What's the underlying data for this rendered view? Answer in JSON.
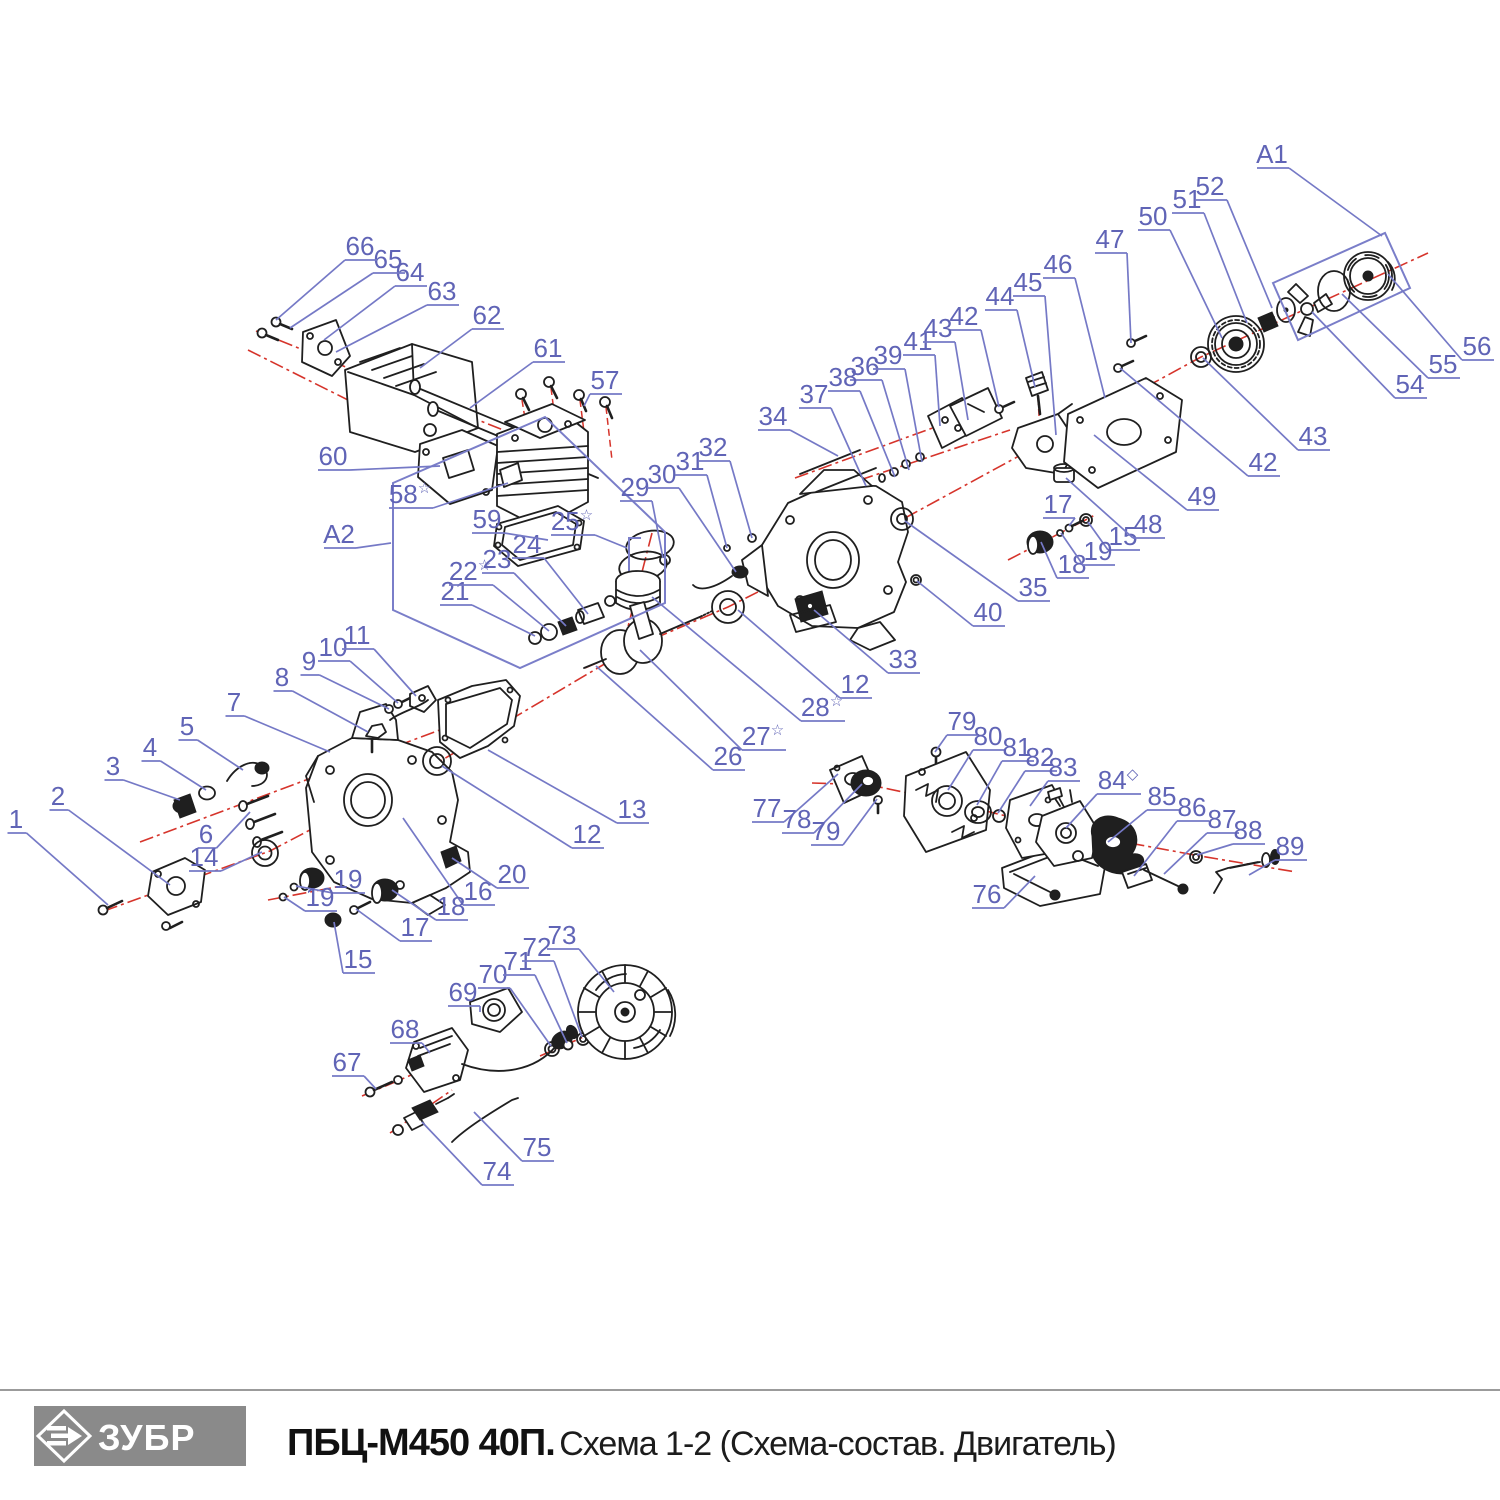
{
  "doc": {
    "kind": "exploded-parts-diagram",
    "product_line": "chainsaw engine parts schematic"
  },
  "footer": {
    "logo_text": "ЗУБР",
    "model": "ПБЦ-М450 40П.",
    "subtitle": "Схема 1-2 (Схема-состав. Двигатель)"
  },
  "colors": {
    "ink": "#1f1f1f",
    "centerline": "#d6342b",
    "label": "#6064b6",
    "leader": "#7579c6",
    "box": "#7a7ec9",
    "logo_bg": "#8a8a8a",
    "rule": "#9b9b9b",
    "title": "#111111"
  },
  "assembly_boxes": [
    {
      "label": "A1",
      "points": "1273,283 1385,233 1410,288 1298,340"
    },
    {
      "label": "A2",
      "points": "393,483 545,417 665,532 665,603 520,668 393,610"
    }
  ],
  "callouts": [
    {
      "t": "1",
      "x": 16,
      "y": 820,
      "ax": 108,
      "ay": 905
    },
    {
      "t": "2",
      "x": 58,
      "y": 797,
      "ax": 170,
      "ay": 885
    },
    {
      "t": "3",
      "x": 113,
      "y": 767,
      "ax": 180,
      "ay": 800
    },
    {
      "t": "4",
      "x": 150,
      "y": 748,
      "ax": 206,
      "ay": 790
    },
    {
      "t": "5",
      "x": 187,
      "y": 727,
      "ax": 243,
      "ay": 770
    },
    {
      "t": "6",
      "x": 206,
      "y": 835,
      "ax": 250,
      "ay": 812
    },
    {
      "t": "7",
      "x": 234,
      "y": 703,
      "ax": 330,
      "ay": 752
    },
    {
      "t": "8",
      "x": 282,
      "y": 678,
      "ax": 368,
      "ay": 732
    },
    {
      "t": "9",
      "x": 309,
      "y": 662,
      "ax": 389,
      "ay": 709
    },
    {
      "t": "10",
      "x": 333,
      "y": 648,
      "ax": 398,
      "ay": 703
    },
    {
      "t": "11",
      "x": 357,
      "y": 636,
      "ax": 416,
      "ay": 696
    },
    {
      "t": "12",
      "x": 587,
      "y": 835,
      "ax": 442,
      "ay": 766
    },
    {
      "t": "12",
      "x": 855,
      "y": 685,
      "ax": 738,
      "ay": 610
    },
    {
      "t": "13",
      "x": 632,
      "y": 810,
      "ax": 488,
      "ay": 750
    },
    {
      "t": "14",
      "x": 204,
      "y": 858,
      "ax": 262,
      "ay": 852
    },
    {
      "t": "15",
      "x": 358,
      "y": 960,
      "ax": 334,
      "ay": 922
    },
    {
      "t": "15",
      "x": 1123,
      "y": 537,
      "ax": 1088,
      "ay": 522
    },
    {
      "t": "16",
      "x": 478,
      "y": 892,
      "ax": 403,
      "ay": 818
    },
    {
      "t": "17",
      "x": 415,
      "y": 928,
      "ax": 356,
      "ay": 909
    },
    {
      "t": "17",
      "x": 1058,
      "y": 505,
      "ax": 1069,
      "ay": 526
    },
    {
      "t": "18",
      "x": 451,
      "y": 907,
      "ax": 392,
      "ay": 890
    },
    {
      "t": "18",
      "x": 1072,
      "y": 565,
      "ax": 1041,
      "ay": 542
    },
    {
      "t": "19",
      "x": 348,
      "y": 880,
      "ax": 296,
      "ay": 886
    },
    {
      "t": "19",
      "x": 320,
      "y": 898,
      "ax": 284,
      "ay": 897
    },
    {
      "t": "19",
      "x": 1098,
      "y": 552,
      "ax": 1061,
      "ay": 533
    },
    {
      "t": "20",
      "x": 512,
      "y": 875,
      "ax": 452,
      "ay": 858
    },
    {
      "t": "21",
      "x": 455,
      "y": 592,
      "ax": 535,
      "ay": 636
    },
    {
      "t": "22",
      "sup": "☆",
      "x": 470,
      "y": 572,
      "ax": 549,
      "ay": 631
    },
    {
      "t": "23",
      "x": 497,
      "y": 560,
      "ax": 566,
      "ay": 626
    },
    {
      "t": "24",
      "x": 527,
      "y": 545,
      "ax": 588,
      "ay": 614
    },
    {
      "t": "25",
      "sup": "☆",
      "x": 572,
      "y": 522,
      "ax": 627,
      "ay": 548
    },
    {
      "t": "26",
      "x": 728,
      "y": 757,
      "ax": 596,
      "ay": 666
    },
    {
      "t": "27",
      "sup": "☆",
      "x": 763,
      "y": 737,
      "ax": 640,
      "ay": 650
    },
    {
      "t": "28",
      "sup": "☆",
      "x": 822,
      "y": 708,
      "ax": 652,
      "ay": 597
    },
    {
      "t": "29",
      "x": 635,
      "y": 488,
      "ax": 663,
      "ay": 558
    },
    {
      "t": "30",
      "x": 662,
      "y": 475,
      "ax": 736,
      "ay": 572
    },
    {
      "t": "31",
      "x": 690,
      "y": 462,
      "ax": 727,
      "ay": 548
    },
    {
      "t": "32",
      "x": 713,
      "y": 448,
      "ax": 752,
      "ay": 538
    },
    {
      "t": "33",
      "x": 903,
      "y": 660,
      "ax": 814,
      "ay": 610
    },
    {
      "t": "34",
      "x": 773,
      "y": 417,
      "ax": 838,
      "ay": 456
    },
    {
      "t": "35",
      "x": 1033,
      "y": 588,
      "ax": 905,
      "ay": 521
    },
    {
      "t": "36",
      "x": 865,
      "y": 367,
      "ax": 909,
      "ay": 470
    },
    {
      "t": "37",
      "x": 814,
      "y": 395,
      "ax": 866,
      "ay": 486
    },
    {
      "t": "38",
      "x": 843,
      "y": 378,
      "ax": 895,
      "ay": 477
    },
    {
      "t": "39",
      "x": 888,
      "y": 356,
      "ax": 922,
      "ay": 462
    },
    {
      "t": "40",
      "x": 988,
      "y": 613,
      "ax": 917,
      "ay": 581
    },
    {
      "t": "41",
      "x": 918,
      "y": 342,
      "ax": 940,
      "ay": 426
    },
    {
      "t": "42",
      "x": 964,
      "y": 317,
      "ax": 999,
      "ay": 407
    },
    {
      "t": "42",
      "x": 1263,
      "y": 463,
      "ax": 1120,
      "ay": 368
    },
    {
      "t": "43",
      "x": 938,
      "y": 329,
      "ax": 968,
      "ay": 420
    },
    {
      "t": "43",
      "x": 1313,
      "y": 437,
      "ax": 1203,
      "ay": 358
    },
    {
      "t": "44",
      "x": 1000,
      "y": 297,
      "ax": 1035,
      "ay": 387
    },
    {
      "t": "45",
      "x": 1028,
      "y": 283,
      "ax": 1056,
      "ay": 435
    },
    {
      "t": "46",
      "x": 1058,
      "y": 265,
      "ax": 1105,
      "ay": 398
    },
    {
      "t": "47",
      "x": 1110,
      "y": 240,
      "ax": 1131,
      "ay": 343
    },
    {
      "t": "48",
      "x": 1148,
      "y": 525,
      "ax": 1066,
      "ay": 478
    },
    {
      "t": "49",
      "x": 1202,
      "y": 497,
      "ax": 1094,
      "ay": 435
    },
    {
      "t": "50",
      "x": 1153,
      "y": 217,
      "ax": 1222,
      "ay": 338
    },
    {
      "t": "51",
      "x": 1187,
      "y": 200,
      "ax": 1247,
      "ay": 323
    },
    {
      "t": "52",
      "x": 1210,
      "y": 187,
      "ax": 1272,
      "ay": 308
    },
    {
      "t": "54",
      "x": 1410,
      "y": 385,
      "ax": 1312,
      "ay": 312
    },
    {
      "t": "55",
      "x": 1443,
      "y": 365,
      "ax": 1342,
      "ay": 294
    },
    {
      "t": "56",
      "x": 1477,
      "y": 347,
      "ax": 1388,
      "ay": 274
    },
    {
      "t": "57",
      "x": 605,
      "y": 381,
      "ax": 584,
      "ay": 406
    },
    {
      "t": "58",
      "sup": "☆",
      "x": 410,
      "y": 495,
      "ax": 508,
      "ay": 483
    },
    {
      "t": "59",
      "x": 487,
      "y": 520,
      "ax": 548,
      "ay": 540
    },
    {
      "t": "60",
      "x": 333,
      "y": 457,
      "ax": 440,
      "ay": 466
    },
    {
      "t": "61",
      "x": 548,
      "y": 349,
      "ax": 470,
      "ay": 408
    },
    {
      "t": "62",
      "x": 487,
      "y": 316,
      "ax": 420,
      "ay": 368
    },
    {
      "t": "63",
      "x": 442,
      "y": 292,
      "ax": 336,
      "ay": 352
    },
    {
      "t": "64",
      "x": 410,
      "y": 273,
      "ax": 324,
      "ay": 340
    },
    {
      "t": "65",
      "x": 388,
      "y": 260,
      "ax": 290,
      "ay": 328
    },
    {
      "t": "66",
      "x": 360,
      "y": 247,
      "ax": 276,
      "ay": 320
    },
    {
      "t": "67",
      "x": 347,
      "y": 1063,
      "ax": 376,
      "ay": 1089
    },
    {
      "t": "68",
      "x": 405,
      "y": 1030,
      "ax": 430,
      "ay": 1053
    },
    {
      "t": "69",
      "x": 463,
      "y": 993,
      "ax": 480,
      "ay": 1012
    },
    {
      "t": "70",
      "x": 493,
      "y": 975,
      "ax": 551,
      "ay": 1046
    },
    {
      "t": "71",
      "x": 518,
      "y": 962,
      "ax": 567,
      "ay": 1043
    },
    {
      "t": "72",
      "x": 537,
      "y": 948,
      "ax": 582,
      "ay": 1037
    },
    {
      "t": "73",
      "x": 562,
      "y": 936,
      "ax": 614,
      "ay": 992
    },
    {
      "t": "74",
      "x": 497,
      "y": 1172,
      "ax": 422,
      "ay": 1122
    },
    {
      "t": "75",
      "x": 537,
      "y": 1148,
      "ax": 474,
      "ay": 1112
    },
    {
      "t": "76",
      "x": 987,
      "y": 895,
      "ax": 1035,
      "ay": 876
    },
    {
      "t": "77",
      "x": 767,
      "y": 809,
      "ax": 838,
      "ay": 774
    },
    {
      "t": "78",
      "x": 797,
      "y": 820,
      "ax": 862,
      "ay": 784
    },
    {
      "t": "79",
      "x": 826,
      "y": 832,
      "ax": 877,
      "ay": 799
    },
    {
      "t": "79",
      "x": 962,
      "y": 722,
      "ax": 935,
      "ay": 752
    },
    {
      "t": "80",
      "x": 988,
      "y": 737,
      "ax": 948,
      "ay": 790
    },
    {
      "t": "81",
      "x": 1017,
      "y": 748,
      "ax": 977,
      "ay": 805
    },
    {
      "t": "82",
      "x": 1040,
      "y": 758,
      "ax": 998,
      "ay": 813
    },
    {
      "t": "83",
      "x": 1063,
      "y": 768,
      "ax": 1030,
      "ay": 806
    },
    {
      "t": "84",
      "sup": "◇",
      "x": 1118,
      "y": 781,
      "ax": 1066,
      "ay": 828
    },
    {
      "t": "85",
      "x": 1162,
      "y": 797,
      "ax": 1108,
      "ay": 842
    },
    {
      "t": "86",
      "x": 1192,
      "y": 808,
      "ax": 1134,
      "ay": 876
    },
    {
      "t": "87",
      "x": 1222,
      "y": 820,
      "ax": 1164,
      "ay": 874
    },
    {
      "t": "88",
      "x": 1248,
      "y": 831,
      "ax": 1197,
      "ay": 855
    },
    {
      "t": "89",
      "x": 1290,
      "y": 847,
      "ax": 1249,
      "ay": 875
    },
    {
      "t": "A1",
      "x": 1272,
      "y": 155,
      "ax": 1382,
      "ay": 236
    },
    {
      "t": "A2",
      "x": 339,
      "y": 535,
      "ax": 391,
      "ay": 543
    }
  ]
}
